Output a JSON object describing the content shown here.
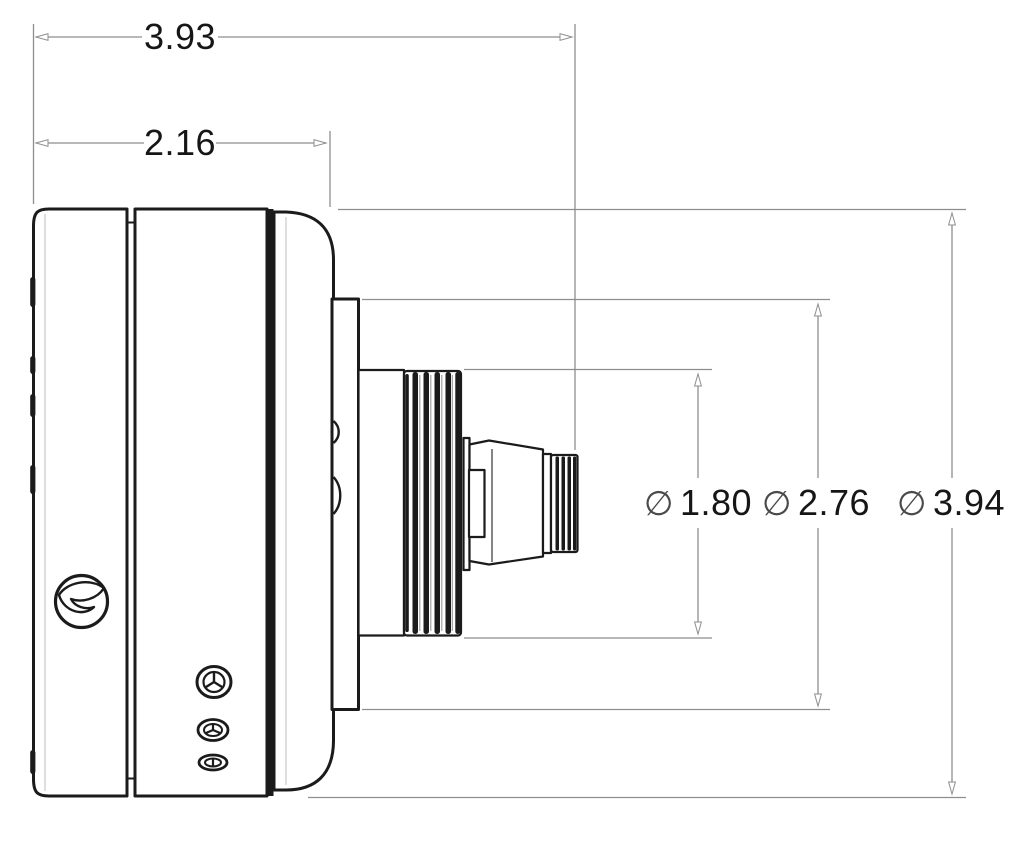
{
  "page": {
    "background": "#ffffff"
  },
  "drawing": {
    "type": "technical-dimension-drawing",
    "view": "camera-housing-side-view",
    "colors": {
      "object_line": "#1b1b1b",
      "dimension_line": "#8e8e8e",
      "label_text": "#161616"
    },
    "dimensions": {
      "total_length": {
        "value": "3.93"
      },
      "body_length": {
        "value": "2.16"
      },
      "lens_diameter": {
        "symbol": "∅",
        "value": "1.80"
      },
      "mount_diameter": {
        "symbol": "∅",
        "value": "2.76"
      },
      "body_diameter": {
        "symbol": "∅",
        "value": "3.94"
      }
    },
    "icons": {
      "logo": "brand-swirl-logo-icon",
      "screw_top": "triwing-screw-icon",
      "screw_middle": "triwing-screw-icon",
      "screw_bottom": "slot-screw-icon"
    }
  }
}
